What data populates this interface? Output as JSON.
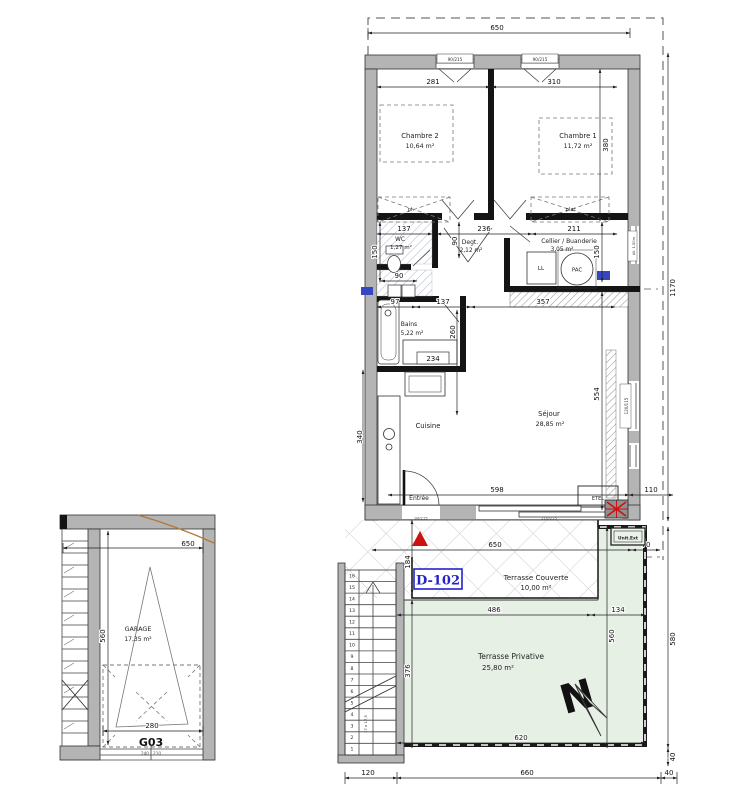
{
  "plan": {
    "unit_label": "D-102",
    "garage_label": "G03",
    "north": "N",
    "rooms": {
      "chambre2": {
        "name": "Chambre 2",
        "area": "10,64 m²"
      },
      "chambre1": {
        "name": "Chambre 1",
        "area": "11,72 m²"
      },
      "wc": {
        "name": "WC",
        "area": "1,27 m²"
      },
      "degagement": {
        "name": "Degt.",
        "area": "2,12 m²"
      },
      "cellier": {
        "name": "Cellier / Buanderie",
        "area": "3,05 m²"
      },
      "bains": {
        "name": "Bains",
        "area": "5,22 m²"
      },
      "cuisine": {
        "name": "Cuisine"
      },
      "sejour": {
        "name": "Séjour",
        "area": "28,85 m²"
      },
      "entree": {
        "name": "Entrée"
      },
      "terrasse_couverte": {
        "name": "Terrasse Couverte",
        "area": "10,00 m²"
      },
      "terrasse_privative": {
        "name": "Terrasse Privative",
        "area": "25,80 m²"
      },
      "garage": {
        "name": "GARAGE",
        "area": "17,35 m²"
      }
    },
    "equipment": {
      "washer": "LL",
      "heat_pump": "PAC",
      "etel": "ETEL",
      "ext_unit": "Unit.Ext",
      "closet_left": "pl.",
      "closet_right": "plac"
    },
    "openings": {
      "bedroom_window": "90/215",
      "entry_door": "90/215",
      "bay_window": "210/215",
      "cellier_window": "All. 1.50m",
      "sejour_window": "120/115",
      "garage_door": "240 | 210"
    },
    "stairs": {
      "steps": [
        "1",
        "2",
        "3",
        "4",
        "5",
        "6",
        "7",
        "8",
        "9",
        "10",
        "11",
        "12",
        "13",
        "14",
        "15",
        "16"
      ],
      "note": "17 x 17,5"
    },
    "dims": {
      "top": "650",
      "height_right": "1170",
      "ch2_w": "281",
      "ch1_w": "310",
      "ch1_h": "380",
      "wc_w": "137",
      "degt_w": "236",
      "cellier_w": "211",
      "degt_h": "90",
      "wc_h": "150",
      "cellier_h": "150",
      "niche_w": "90",
      "col_w": "97",
      "bains_w": "137",
      "hall_w": "357",
      "bains_h": "260",
      "cuisine_h": "340",
      "sejour_h": "554",
      "sejour_w": "598",
      "offset_right": "110",
      "tc_w": "650",
      "ext_offset": "70",
      "tc_h": "184",
      "tp_wa": "486",
      "tp_wb": "134",
      "tp_h": "560",
      "tp_inner": "376",
      "tp_bottom": "620",
      "right_h": "580",
      "right_s": "40",
      "bot_stairs": "120",
      "bot_main": "660",
      "bot_right": "40",
      "vanity": "234",
      "garage_top": "650",
      "garage_h": "560",
      "garage_door_w": "280"
    },
    "colors": {
      "terrace_green": "#e6f0e5",
      "unit_blue": "#2323cc",
      "marker_red": "#cc1111",
      "wall_gray": "#b4b4b4",
      "terrain_orange": "#b5763a"
    }
  }
}
